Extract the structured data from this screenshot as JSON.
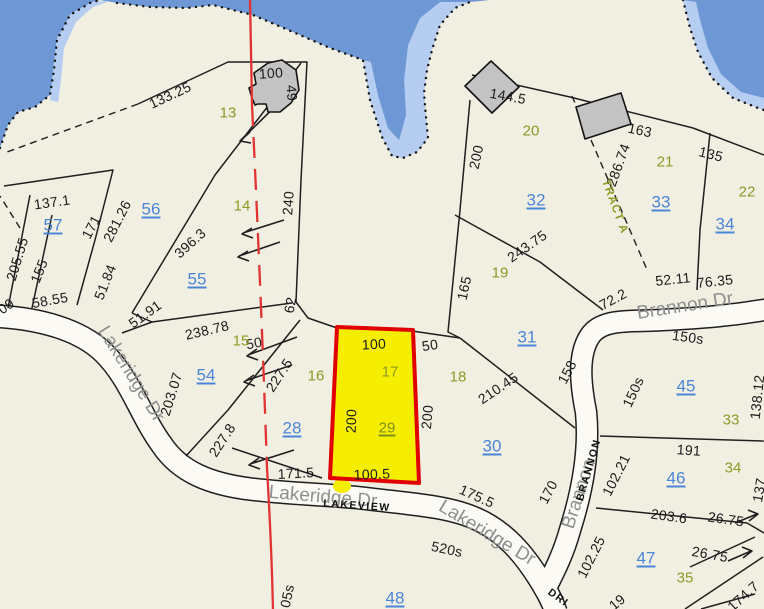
{
  "map": {
    "type": "parcel-plat-map",
    "selected_parcel": {
      "lot": "29",
      "frontage": "100.5",
      "top": "100",
      "depth_left": "200",
      "depth_right": "200"
    },
    "colors": {
      "land": "#f1eee2",
      "water": "#6e98d5",
      "water_light": "#b5cdf1",
      "lot_number_blue": "#4a86d8",
      "plan_number_olive": "#8e9a25",
      "selected_olive": "#7d8f1d",
      "selected_fill": "#f6ee00",
      "selected_stroke": "#e00000",
      "boundary_red": "#e23333"
    },
    "roads": [
      "Lakeridge Dr",
      "Brannon Dr",
      "Lakeview",
      "Brannon Drive"
    ],
    "labels": {
      "dimensions": [
        {
          "t": "133.25",
          "x": 170,
          "y": 95,
          "r": -25
        },
        {
          "t": "100",
          "x": 271,
          "y": 73,
          "r": -4
        },
        {
          "t": "49",
          "x": 292,
          "y": 93,
          "r": 85
        },
        {
          "t": "137.1",
          "x": 52,
          "y": 202,
          "r": -8
        },
        {
          "t": "171",
          "x": 91,
          "y": 227,
          "r": -62
        },
        {
          "t": "281.26",
          "x": 117,
          "y": 221,
          "r": -63
        },
        {
          "t": "396.3",
          "x": 190,
          "y": 243,
          "r": -42
        },
        {
          "t": "240",
          "x": 288,
          "y": 203,
          "r": -86
        },
        {
          "t": "205.55",
          "x": 17,
          "y": 259,
          "r": -73
        },
        {
          "t": "155",
          "x": 39,
          "y": 271,
          "r": -68
        },
        {
          "t": "58.55",
          "x": 50,
          "y": 300,
          "r": -10
        },
        {
          "t": "09",
          "x": 6,
          "y": 306,
          "r": -35
        },
        {
          "t": "51.84",
          "x": 105,
          "y": 282,
          "r": -68
        },
        {
          "t": "51.91",
          "x": 145,
          "y": 314,
          "r": -36
        },
        {
          "t": "238.78",
          "x": 207,
          "y": 330,
          "r": -13
        },
        {
          "t": "203.07",
          "x": 171,
          "y": 394,
          "r": -73
        },
        {
          "t": "227.8",
          "x": 222,
          "y": 440,
          "r": -57
        },
        {
          "t": "227.5",
          "x": 279,
          "y": 375,
          "r": -57
        },
        {
          "t": "62",
          "x": 290,
          "y": 305,
          "r": -80
        },
        {
          "t": "50",
          "x": 254,
          "y": 343,
          "r": -10
        },
        {
          "t": "100",
          "x": 374,
          "y": 344,
          "r": -3
        },
        {
          "t": "50",
          "x": 430,
          "y": 345,
          "r": -8
        },
        {
          "t": "200",
          "x": 351,
          "y": 421,
          "r": -88
        },
        {
          "t": "200",
          "x": 427,
          "y": 417,
          "r": -85
        },
        {
          "t": "100.5",
          "x": 372,
          "y": 474,
          "r": -2
        },
        {
          "t": "171.5",
          "x": 296,
          "y": 473,
          "r": -3
        },
        {
          "t": "175.5",
          "x": 477,
          "y": 496,
          "r": 24
        },
        {
          "t": "520s",
          "x": 447,
          "y": 549,
          "r": 12
        },
        {
          "t": "170",
          "x": 548,
          "y": 492,
          "r": -62
        },
        {
          "t": "158",
          "x": 567,
          "y": 372,
          "r": -62
        },
        {
          "t": "210.45",
          "x": 498,
          "y": 388,
          "r": -34
        },
        {
          "t": "165",
          "x": 464,
          "y": 288,
          "r": -78
        },
        {
          "t": "243.75",
          "x": 527,
          "y": 246,
          "r": -35
        },
        {
          "t": "72.2",
          "x": 613,
          "y": 299,
          "r": -28
        },
        {
          "t": "52.11",
          "x": 673,
          "y": 279,
          "r": -6
        },
        {
          "t": "76.35",
          "x": 715,
          "y": 281,
          "r": -6
        },
        {
          "t": "150s",
          "x": 688,
          "y": 337,
          "r": 8
        },
        {
          "t": "150s",
          "x": 633,
          "y": 392,
          "r": -65
        },
        {
          "t": "138.12",
          "x": 757,
          "y": 397,
          "r": -84
        },
        {
          "t": "191",
          "x": 689,
          "y": 450,
          "r": 4
        },
        {
          "t": "102.21",
          "x": 616,
          "y": 475,
          "r": -63
        },
        {
          "t": "102.25",
          "x": 591,
          "y": 557,
          "r": -63
        },
        {
          "t": "203.6",
          "x": 669,
          "y": 516,
          "r": 8
        },
        {
          "t": "26.75",
          "x": 726,
          "y": 519,
          "r": 8
        },
        {
          "t": "26.75",
          "x": 710,
          "y": 554,
          "r": 10
        },
        {
          "t": "174.7",
          "x": 743,
          "y": 596,
          "r": -42
        },
        {
          "t": "144.5",
          "x": 508,
          "y": 96,
          "r": 10
        },
        {
          "t": "163",
          "x": 640,
          "y": 130,
          "r": 12
        },
        {
          "t": "286.74",
          "x": 618,
          "y": 165,
          "r": -70
        },
        {
          "t": "200",
          "x": 476,
          "y": 157,
          "r": -78
        },
        {
          "t": "135",
          "x": 711,
          "y": 154,
          "r": 14
        },
        {
          "t": "137",
          "x": 759,
          "y": 490,
          "r": -80
        },
        {
          "t": "05s",
          "x": 287,
          "y": 596,
          "r": -78
        },
        {
          "t": "19",
          "x": 617,
          "y": 602,
          "r": -40
        }
      ],
      "lot_numbers": [
        {
          "t": "57",
          "x": 53,
          "y": 225,
          "r": 0
        },
        {
          "t": "56",
          "x": 151,
          "y": 209,
          "r": 0
        },
        {
          "t": "55",
          "x": 197,
          "y": 279,
          "r": 0
        },
        {
          "t": "54",
          "x": 206,
          "y": 375,
          "r": 0
        },
        {
          "t": "28",
          "x": 292,
          "y": 428,
          "r": 0
        },
        {
          "t": "32",
          "x": 536,
          "y": 200,
          "r": 0
        },
        {
          "t": "33",
          "x": 661,
          "y": 202,
          "r": 0
        },
        {
          "t": "34",
          "x": 725,
          "y": 224,
          "r": 0
        },
        {
          "t": "31",
          "x": 527,
          "y": 337,
          "r": 0
        },
        {
          "t": "30",
          "x": 492,
          "y": 446,
          "r": 0
        },
        {
          "t": "45",
          "x": 686,
          "y": 386,
          "r": 0
        },
        {
          "t": "46",
          "x": 676,
          "y": 478,
          "r": 0
        },
        {
          "t": "47",
          "x": 646,
          "y": 558,
          "r": 0
        },
        {
          "t": "48",
          "x": 395,
          "y": 598,
          "r": 0
        }
      ],
      "selected_lot": {
        "t": "29",
        "x": 387,
        "y": 428,
        "r": 0
      },
      "plan_numbers": [
        {
          "t": "13",
          "x": 228,
          "y": 113,
          "r": 0
        },
        {
          "t": "14",
          "x": 242,
          "y": 206,
          "r": 0
        },
        {
          "t": "15",
          "x": 241,
          "y": 341,
          "r": 0
        },
        {
          "t": "16",
          "x": 316,
          "y": 376,
          "r": 0
        },
        {
          "t": "17",
          "x": 390,
          "y": 372,
          "r": 0
        },
        {
          "t": "18",
          "x": 458,
          "y": 377,
          "r": 0
        },
        {
          "t": "19",
          "x": 500,
          "y": 273,
          "r": 0
        },
        {
          "t": "20",
          "x": 531,
          "y": 131,
          "r": 0
        },
        {
          "t": "21",
          "x": 665,
          "y": 162,
          "r": 0
        },
        {
          "t": "22",
          "x": 747,
          "y": 192,
          "r": 0
        },
        {
          "t": "33",
          "x": 731,
          "y": 420,
          "r": 0
        },
        {
          "t": "34",
          "x": 733,
          "y": 468,
          "r": 0
        },
        {
          "t": "35",
          "x": 685,
          "y": 578,
          "r": 0
        }
      ],
      "tract": {
        "t": "TRACT A",
        "x": 614,
        "y": 207,
        "r": 70
      },
      "road_names": [
        {
          "t": "Lakeridge Dr",
          "x": 131,
          "y": 374,
          "r": 58
        },
        {
          "t": "Lakeridge Dr",
          "x": 323,
          "y": 497,
          "r": 5
        },
        {
          "t": "Lakeridge Dr",
          "x": 487,
          "y": 533,
          "r": 31
        },
        {
          "t": "Brannon Dr",
          "x": 685,
          "y": 306,
          "r": -9
        },
        {
          "t": "Brannon",
          "x": 579,
          "y": 494,
          "r": -72
        }
      ],
      "road_caps": [
        {
          "t": "LAKEVIEW",
          "x": 357,
          "y": 506,
          "r": 4
        },
        {
          "t": "BRANNON",
          "x": 589,
          "y": 470,
          "r": -74
        },
        {
          "t": "DRI",
          "x": 558,
          "y": 598,
          "r": 36
        }
      ]
    }
  }
}
